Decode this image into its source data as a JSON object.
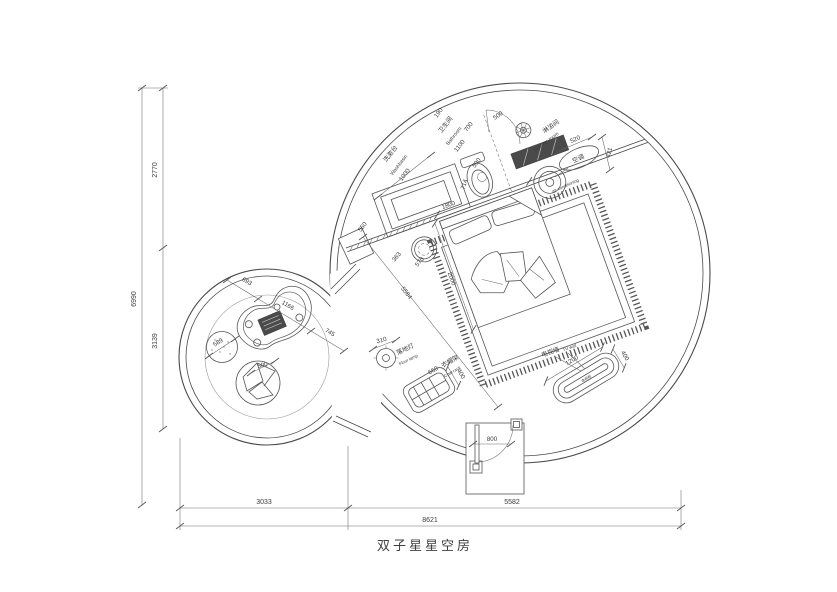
{
  "title": "双子星星空房",
  "labels": {
    "washbasin_cn": "洗漱台",
    "washbasin_en": "Washbasin",
    "bathroom_cn": "卫生间",
    "bathroom_en": "Bathroom",
    "shower_cn": "淋浴间",
    "shower_en": "Shower room",
    "ac_cn": "空调",
    "ac_en": "air conditioning",
    "lamp_cn": "落地灯",
    "lamp_en": "Floor lamp",
    "coat_cn": "衣帽架",
    "coat_en": "Coat rack",
    "tv_wall_cn": "电视墙",
    "tv_wall_en": "TV wall",
    "tv_cabinet_cn": "电视柜"
  },
  "dims": {
    "h6990": "6990",
    "v2770": "2770",
    "v3139": "3139",
    "b3033": "3033",
    "b5582": "5582",
    "b8621": "8621",
    "washbasin_len": "1000",
    "washbasin_dep": "550",
    "bath_w": "1100",
    "g190": "190",
    "g700": "700",
    "door500": "500",
    "g590": "590",
    "g714": "714",
    "bed_w": "1800",
    "bed_l": "2000",
    "diag": "5584",
    "s363": "363",
    "s570": "570",
    "bench520": "520",
    "ac421": "421",
    "lamp310": "310",
    "coat660": "660",
    "coat400": "400",
    "tv1200": "1200",
    "tv400": "400",
    "door800": "800",
    "t693": "693",
    "t1166": "1166",
    "t745": "745",
    "pouf589": "589",
    "bean500": "500"
  },
  "colors": {
    "line": "#4a4a4a",
    "dim": "#6a6a6a",
    "dark_fill": "#4a4a4a",
    "text": "#3c3c3c",
    "background": "#ffffff"
  }
}
